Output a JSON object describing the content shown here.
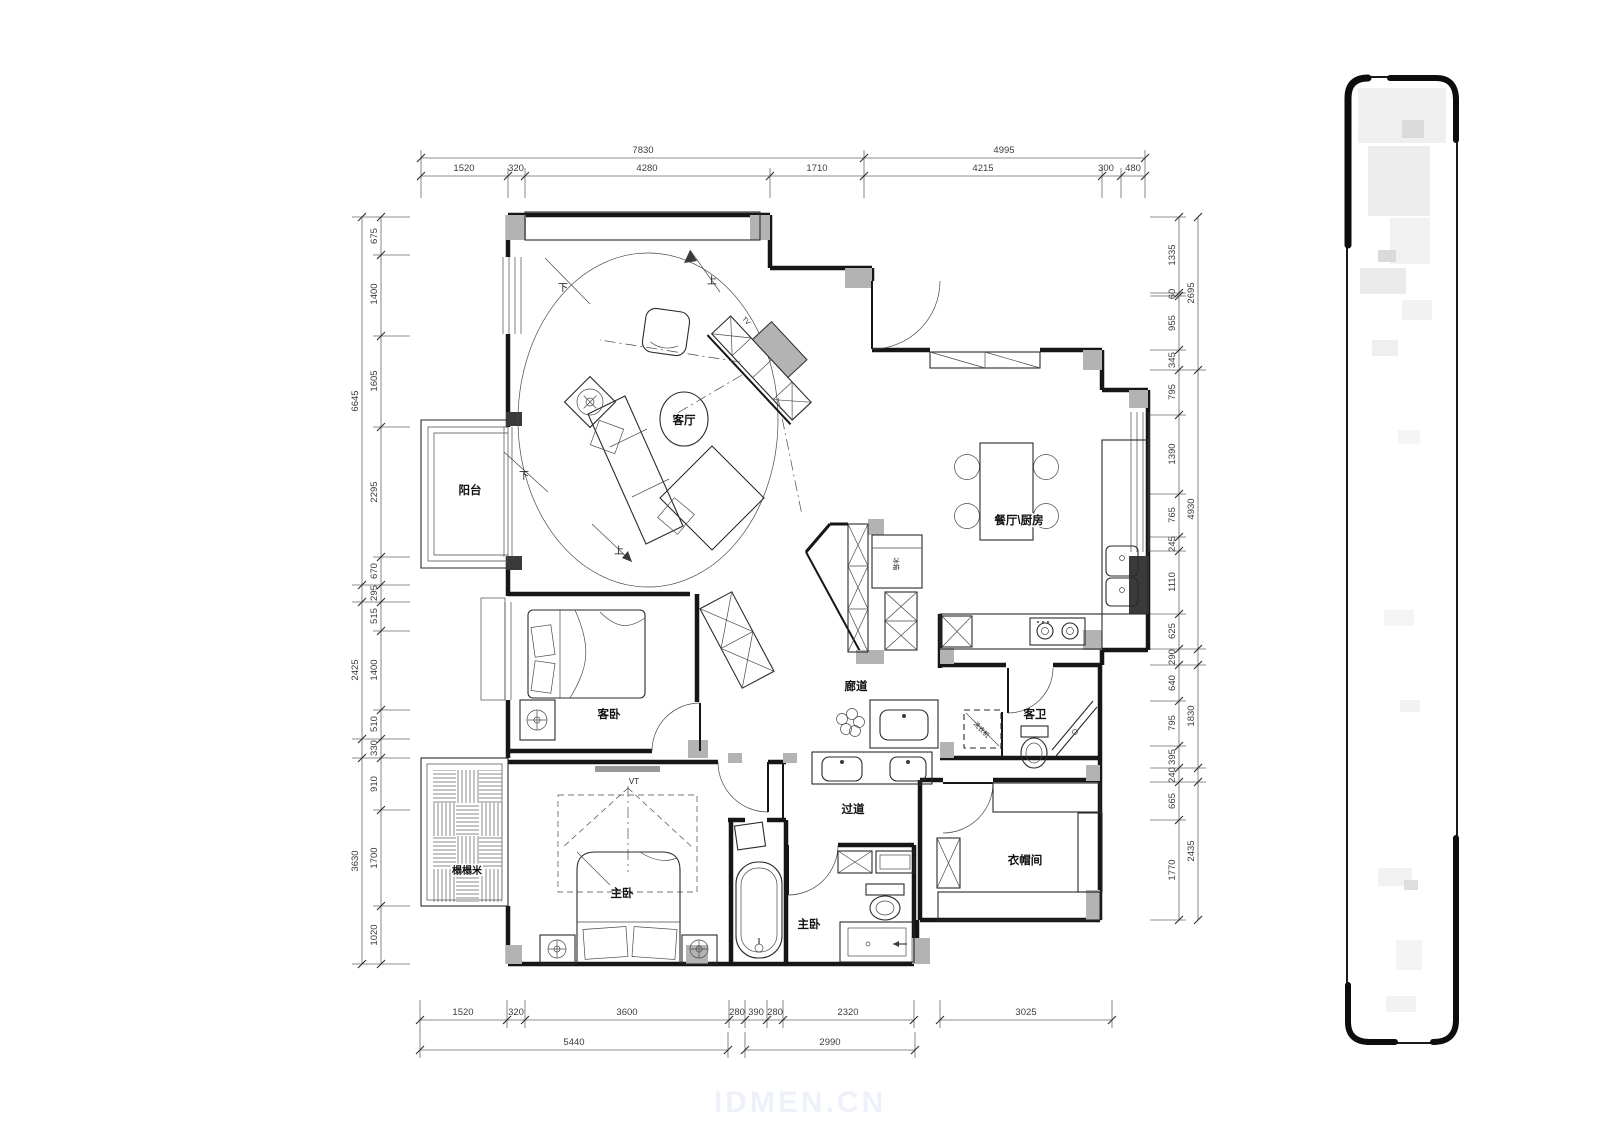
{
  "watermark": "IDMEN.CN",
  "rooms": {
    "living": "客厅",
    "balcony": "阳台",
    "dining_kitchen": "餐厅\\厨房",
    "corridor": "廊道",
    "guest_bedroom": "客卧",
    "hallway": "过道",
    "guest_bath": "客卫",
    "master_bedroom": "主卧",
    "master_bath": "主卧",
    "cloakroom": "衣帽间",
    "tatami": "榻榻米"
  },
  "fixtures": {
    "tv": "TV",
    "tv_point": "VT",
    "fridge": "冰箱",
    "washer": "洗衣机",
    "stair_up": "上",
    "stair_down": "下"
  },
  "dims": {
    "top_row1": [
      "7830",
      "4995"
    ],
    "top_row2": [
      "1520",
      "320",
      "4280",
      "1710",
      "4215",
      "300",
      "480"
    ],
    "bottom_row1": [
      "1520",
      "320",
      "3600",
      "280",
      "390",
      "280",
      "2320",
      "3025"
    ],
    "bottom_row2": [
      "5440",
      "2990"
    ],
    "left_outer": [
      "6645",
      "2425",
      "3630"
    ],
    "left_inner": [
      "675",
      "1400",
      "1605",
      "2295",
      "670",
      "295",
      "515",
      "1400",
      "510",
      "330",
      "910",
      "1700",
      "1020"
    ],
    "right_outer": [
      "2695",
      "4930",
      "1830",
      "2435"
    ],
    "right_inner": [
      "1335",
      "60",
      "955",
      "345",
      "795",
      "1390",
      "765",
      "245",
      "1110",
      "625",
      "290",
      "640",
      "795",
      "395",
      "240",
      "665",
      "1770"
    ]
  },
  "colors": {
    "wall": "#161616",
    "column_fill": "#b3b3b3",
    "dim_text": "#3c3c3c",
    "watermark_color": "#edf1f9"
  }
}
